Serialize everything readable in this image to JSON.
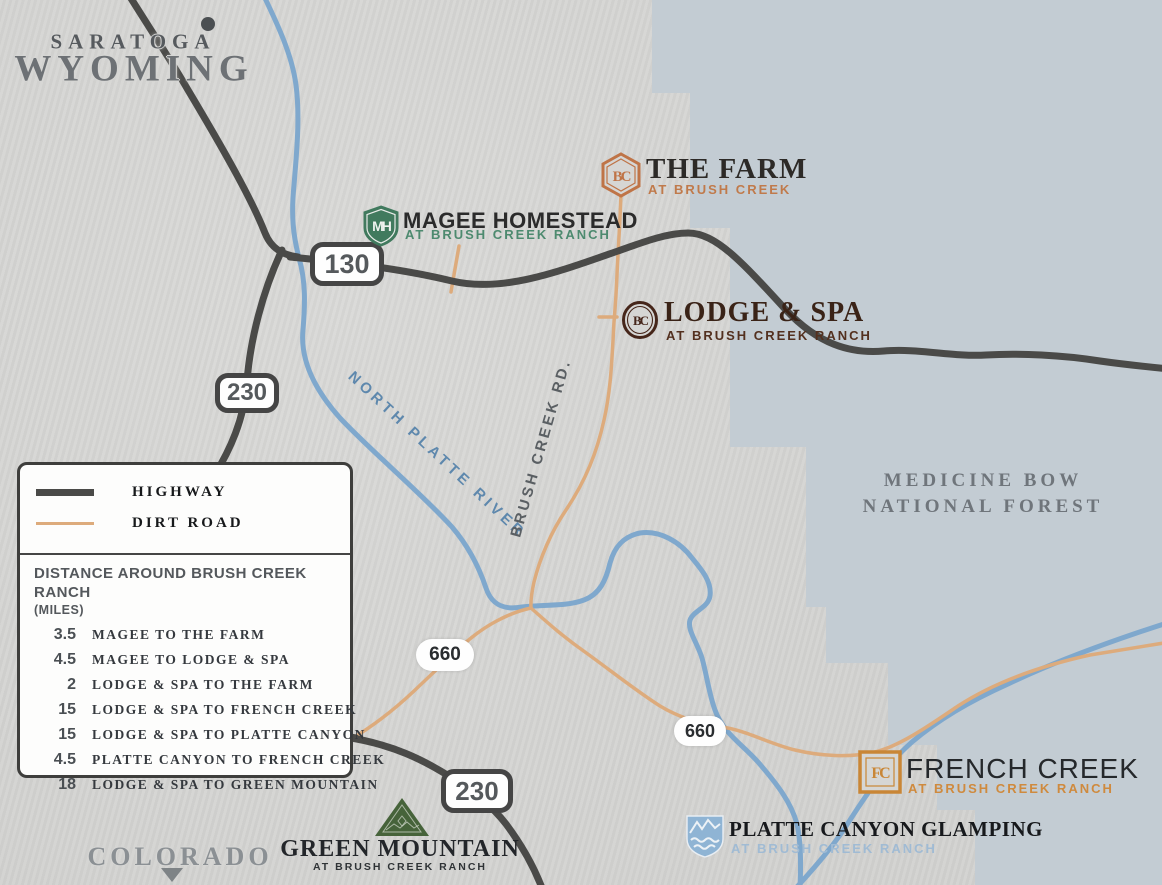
{
  "regions": {
    "town": "SARATOGA",
    "state": "WYOMING",
    "state_south": "COLORADO",
    "forest_line1": "MEDICINE BOW",
    "forest_line2": "NATIONAL FOREST"
  },
  "roads": {
    "river_label": "NORTH PLATTE RIVER",
    "dirt_label": "BRUSH CREEK RD.",
    "badge_130": "130",
    "badge_230": "230",
    "badge_660": "660"
  },
  "properties": {
    "farm": {
      "title": "THE FARM",
      "subtitle": "AT BRUSH CREEK",
      "monogram": "BC"
    },
    "magee": {
      "title": "MAGEE HOMESTEAD",
      "subtitle": "AT BRUSH CREEK RANCH",
      "monogram": "MH"
    },
    "lodge": {
      "title": "LODGE & SPA",
      "subtitle": "AT BRUSH CREEK RANCH",
      "monogram": "BC"
    },
    "french": {
      "title": "FRENCH CREEK",
      "subtitle": "AT BRUSH CREEK RANCH",
      "monogram": "FC"
    },
    "platte": {
      "title": "PLATTE CANYON GLAMPING",
      "subtitle": "AT BRUSH CREEK RANCH"
    },
    "green": {
      "title": "GREEN MOUNTAIN",
      "subtitle": "AT BRUSH CREEK RANCH"
    }
  },
  "legend": {
    "highway_label": "HIGHWAY",
    "dirt_road_label": "DIRT ROAD",
    "distance_title": "DISTANCE AROUND BRUSH CREEK RANCH",
    "distance_unit": "(MILES)",
    "distances": [
      {
        "miles": "3.5",
        "route": "MAGEE TO THE FARM"
      },
      {
        "miles": "4.5",
        "route": "MAGEE TO LODGE & SPA"
      },
      {
        "miles": "2",
        "route": "LODGE & SPA TO THE FARM"
      },
      {
        "miles": "15",
        "route": "LODGE & SPA TO FRENCH CREEK"
      },
      {
        "miles": "15",
        "route": "LODGE & SPA TO PLATTE CANYON"
      },
      {
        "miles": "4.5",
        "route": "PLATTE CANYON TO FRENCH CREEK"
      },
      {
        "miles": "18",
        "route": "LODGE & SPA TO GREEN MOUNTAIN"
      }
    ]
  },
  "colors": {
    "background": "#d6d6d4",
    "forest": "#c3ccd3",
    "highway": "#4a4a48",
    "dirt_road": "#ddab7c",
    "river": "#7fa8cd",
    "farm_accent": "#c07a4b",
    "magee_accent": "#4d8a6f",
    "lodge_accent": "#53301f",
    "french_accent": "#cf8a3e",
    "platte_accent": "#a0bbd4",
    "green_accent": "#46633a"
  }
}
